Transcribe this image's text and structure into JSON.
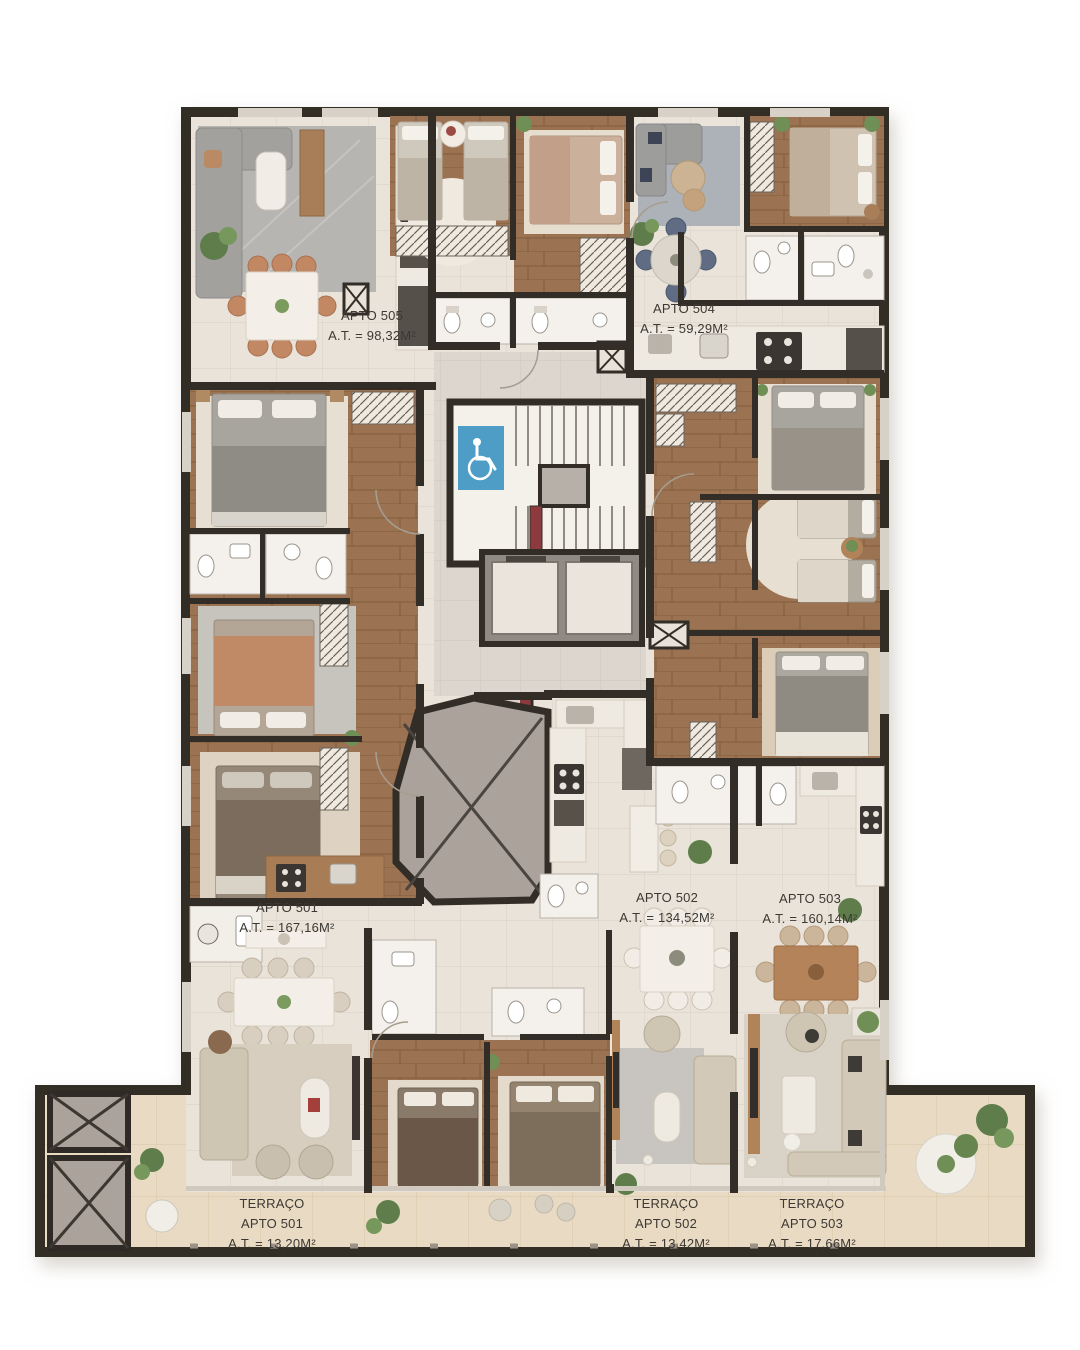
{
  "plan": {
    "units": [
      {
        "id": "apto-501",
        "name": "APTO 501",
        "area": "A.T. = 167,16M²"
      },
      {
        "id": "apto-502",
        "name": "APTO 502",
        "area": "A.T. = 134,52M²"
      },
      {
        "id": "apto-503",
        "name": "APTO 503",
        "area": "A.T. = 160,14M²"
      },
      {
        "id": "apto-504",
        "name": "APTO 504",
        "area": "A.T. = 59,29M²"
      },
      {
        "id": "apto-505",
        "name": "APTO 505",
        "area": "A.T. = 98,32M²"
      }
    ],
    "terraces": [
      {
        "id": "terraco-apto-501",
        "label": "TERRAÇO",
        "unit": "APTO 501",
        "area": "A.T. = 13,20M²"
      },
      {
        "id": "terraco-apto-502",
        "label": "TERRAÇO",
        "unit": "APTO 502",
        "area": "A.T. = 13,42M²"
      },
      {
        "id": "terraco-apto-503",
        "label": "TERRAÇO",
        "unit": "APTO 503",
        "area": "A.T. = 17,66M²"
      }
    ],
    "icons": [
      {
        "name": "accessibility-icon"
      }
    ],
    "colors": {
      "wall": "#332d28",
      "floor_tile": "#eae3d9",
      "wood_floor": "#9b7252",
      "terrace_tile": "#e9dbc3",
      "hall_tile": "#dcd6ce",
      "accessible_blue": "#4d9dc6",
      "hydrant_red": "#8c3a3e",
      "void_gray": "#aba29b",
      "label_text": "#3c3833"
    }
  }
}
